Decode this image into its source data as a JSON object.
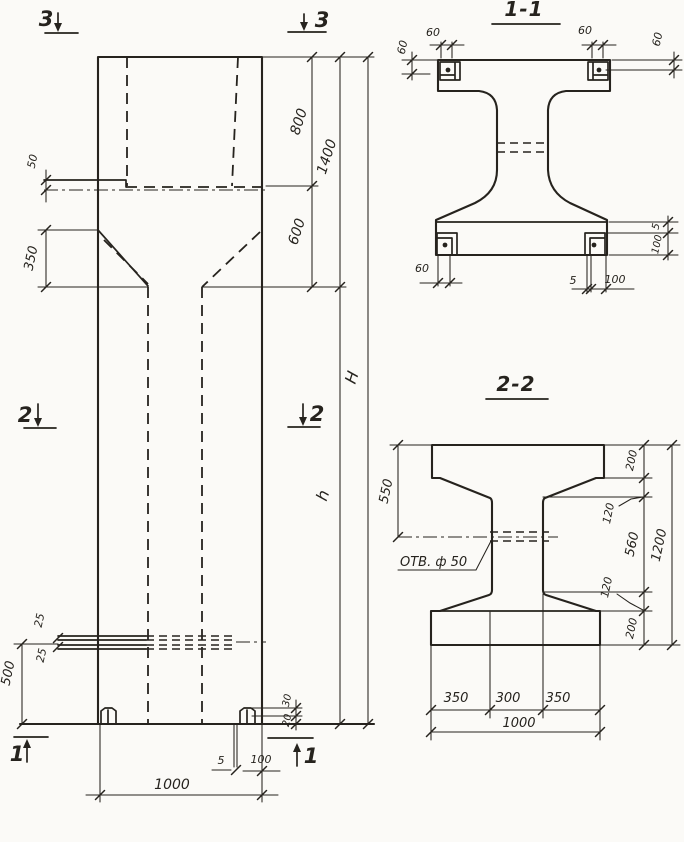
{
  "drawing": {
    "paper_color": "#fbfaf7",
    "ink_color": "#26231e",
    "elevation": {
      "markers": {
        "sec3_left": "3",
        "sec3_right": "3",
        "sec2_left": "2",
        "sec2_right": "2",
        "sec1_left": "1",
        "sec1_right": "1"
      },
      "dims": {
        "ledge_thickness": "50",
        "haunch_height": "350",
        "head_upper": "800",
        "head_lower": "600",
        "head_total": "1400",
        "shaft_height": "h",
        "total_height": "H",
        "plate_upper": "25",
        "plate_lower": "25",
        "plate_level": "500",
        "foot_rise": "30",
        "foot_plate": "20",
        "base_plate_thickness": "5",
        "base_plate_width": "100",
        "column_width": "1000"
      }
    },
    "section11": {
      "title": "1-1",
      "dims": {
        "top_left": "60",
        "top_right": "60",
        "side_left": "60",
        "side_right": "60",
        "bottom_left": "60",
        "bottom_5": "5",
        "bottom_100": "100",
        "right_5": "5",
        "right_100": "100"
      }
    },
    "section22": {
      "title": "2-2",
      "hole_label": "ОТВ. ф 50",
      "dims": {
        "flange_depth": "550",
        "top_200": "200",
        "top_120": "120",
        "web_560": "560",
        "bottom_120": "120",
        "bottom_200": "200",
        "height_total": "1200",
        "left_350": "350",
        "mid_300": "300",
        "right_350": "350",
        "width_total": "1000"
      }
    }
  }
}
